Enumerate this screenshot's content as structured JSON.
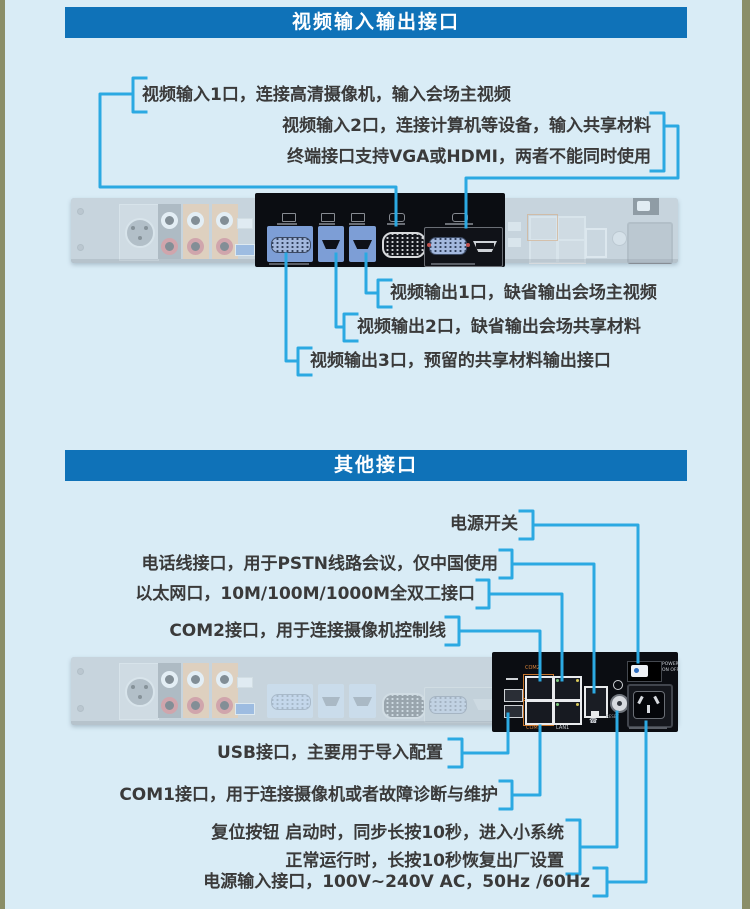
{
  "colors": {
    "page_bg": "#d9ecf6",
    "edge_stripe": "#8a8e68",
    "header_bg": "#0f72b8",
    "header_text": "#ffffff",
    "callout_line": "#2BA9E2",
    "label_text": "#3a3a3a",
    "panel_body": "#b2b9c1",
    "highlight_panel_bg": "#0b0d12",
    "port_tile_blue": "#7d9ed6",
    "audio_strip_orange": "#e2b083",
    "com_port_highlight": "#c8762c"
  },
  "sections": [
    {
      "title": "视频输入输出接口"
    },
    {
      "title": "其他接口"
    }
  ],
  "callouts": {
    "s1": [
      {
        "id": "video-in-1",
        "text": "视频输入1口，连接高清摄像机，输入会场主视频"
      },
      {
        "id": "video-in-2",
        "line1": "视频输入2口，连接计算机等设备，输入共享材料",
        "line2": "终端接口支持VGA或HDMI，两者不能同时使用"
      },
      {
        "id": "video-out-1",
        "text": "视频输出1口，缺省输出会场主视频"
      },
      {
        "id": "video-out-2",
        "text": "视频输出2口，缺省输出会场共享材料"
      },
      {
        "id": "video-out-3",
        "text": "视频输出3口，预留的共享材料输出接口"
      }
    ],
    "s2": [
      {
        "id": "power-switch",
        "text": "电源开关"
      },
      {
        "id": "phone-line",
        "text": "电话线接口，用于PSTN线路会议，仅中国使用"
      },
      {
        "id": "ethernet",
        "text": "以太网口，10M/100M/1000M全双工接口"
      },
      {
        "id": "com2",
        "text": "COM2接口，用于连接摄像机控制线"
      },
      {
        "id": "usb",
        "text": "USB接口，主要用于导入配置"
      },
      {
        "id": "com1",
        "text": "COM1接口，用于连接摄像机或者故障诊断与维护"
      },
      {
        "id": "reset",
        "line1": "复位按钮  启动时，同步长按10秒，进入小系统",
        "line2": "正常运行时，长按10秒恢复出厂设置"
      },
      {
        "id": "power-input",
        "text": "电源输入接口，100V~240V AC，50Hz /60Hz"
      }
    ]
  },
  "device": {
    "com2_port_label": "COM2",
    "com1_port_label": "COM1",
    "lan_port_label": "LAN1",
    "reset_label": "RESET",
    "power_switch_line1": "POWER",
    "power_switch_line2": "ON OFF"
  }
}
